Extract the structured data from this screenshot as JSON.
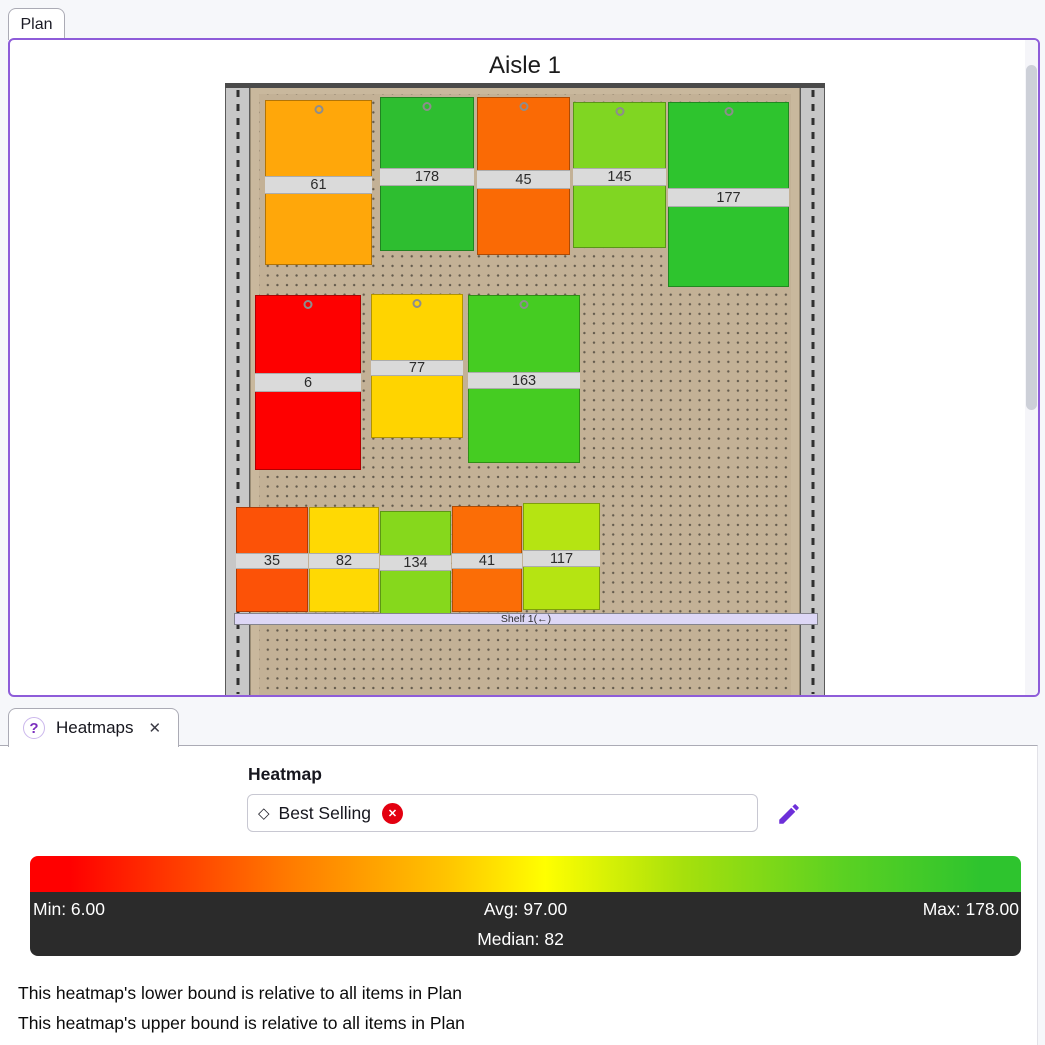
{
  "plan_section": {
    "tab_label": "Plan",
    "title": "Aisle 1",
    "accent_border_color": "#8E5CD9",
    "fixture": {
      "shelf_label": "Shelf 1(←)",
      "pegboard_color": "#C3B196",
      "products": [
        {
          "value": "61",
          "color": "#FFA70A",
          "x": 40,
          "y": 17,
          "w": 107,
          "h": 165,
          "label_offset": 75,
          "label_h": 18,
          "peg": true
        },
        {
          "value": "178",
          "color": "#2EBE30",
          "x": 155,
          "y": 14,
          "w": 94,
          "h": 154,
          "label_offset": 70,
          "label_h": 18,
          "peg": true
        },
        {
          "value": "45",
          "color": "#FA6A05",
          "x": 252,
          "y": 14,
          "w": 93,
          "h": 158,
          "label_offset": 72,
          "label_h": 19,
          "peg": true
        },
        {
          "value": "145",
          "color": "#80D622",
          "x": 348,
          "y": 19,
          "w": 93,
          "h": 146,
          "label_offset": 65,
          "label_h": 18,
          "peg": true
        },
        {
          "value": "177",
          "color": "#2EC42E",
          "x": 443,
          "y": 19,
          "w": 121,
          "h": 185,
          "label_offset": 85,
          "label_h": 19,
          "peg": true
        },
        {
          "value": "6",
          "color": "#FE0000",
          "x": 30,
          "y": 212,
          "w": 106,
          "h": 175,
          "label_offset": 77,
          "label_h": 19,
          "peg": true
        },
        {
          "value": "77",
          "color": "#FFD400",
          "x": 146,
          "y": 211,
          "w": 92,
          "h": 144,
          "label_offset": 65,
          "label_h": 16,
          "peg": true
        },
        {
          "value": "163",
          "color": "#45CC22",
          "x": 243,
          "y": 212,
          "w": 112,
          "h": 168,
          "label_offset": 76,
          "label_h": 17,
          "peg": true
        },
        {
          "value": "35",
          "color": "#FC5207",
          "x": 11,
          "y": 424,
          "w": 72,
          "h": 105,
          "label_offset": 45,
          "label_h": 16,
          "peg": false
        },
        {
          "value": "82",
          "color": "#FFD903",
          "x": 84,
          "y": 424,
          "w": 70,
          "h": 105,
          "label_offset": 45,
          "label_h": 16,
          "peg": false
        },
        {
          "value": "134",
          "color": "#86D81C",
          "x": 155,
          "y": 428,
          "w": 71,
          "h": 103,
          "label_offset": 43,
          "label_h": 16,
          "peg": false
        },
        {
          "value": "41",
          "color": "#FB6D06",
          "x": 227,
          "y": 423,
          "w": 70,
          "h": 106,
          "label_offset": 46,
          "label_h": 16,
          "peg": false
        },
        {
          "value": "117",
          "color": "#B5E412",
          "x": 298,
          "y": 420,
          "w": 77,
          "h": 107,
          "label_offset": 46,
          "label_h": 17,
          "peg": false
        }
      ]
    }
  },
  "heatmaps_section": {
    "tab_label": "Heatmaps",
    "icons": {
      "help": "?",
      "close": "✕",
      "selector_diamond": "◇",
      "remove": "✕",
      "edit_pencil_color": "#6D2FD9"
    },
    "field_label": "Heatmap",
    "combobox": {
      "selected": "Best Selling"
    },
    "legend": {
      "gradient_stops": [
        "#FF0000 0%",
        "#FF0000 4%",
        "#FF7A00 26%",
        "#FFC400 42%",
        "#FFFF00 52%",
        "#A6E00C 66%",
        "#5BD122 82%",
        "#2EC42E 96%",
        "#2EC42E 100%"
      ],
      "stats_bar_color": "#2B2B2B",
      "min": "Min: 6.00",
      "avg": "Avg: 97.00",
      "median": "Median: 82",
      "max": "Max: 178.00"
    },
    "notes": [
      "This heatmap's lower bound is relative to all items in Plan",
      "This heatmap's upper bound is relative to all items in Plan"
    ]
  }
}
